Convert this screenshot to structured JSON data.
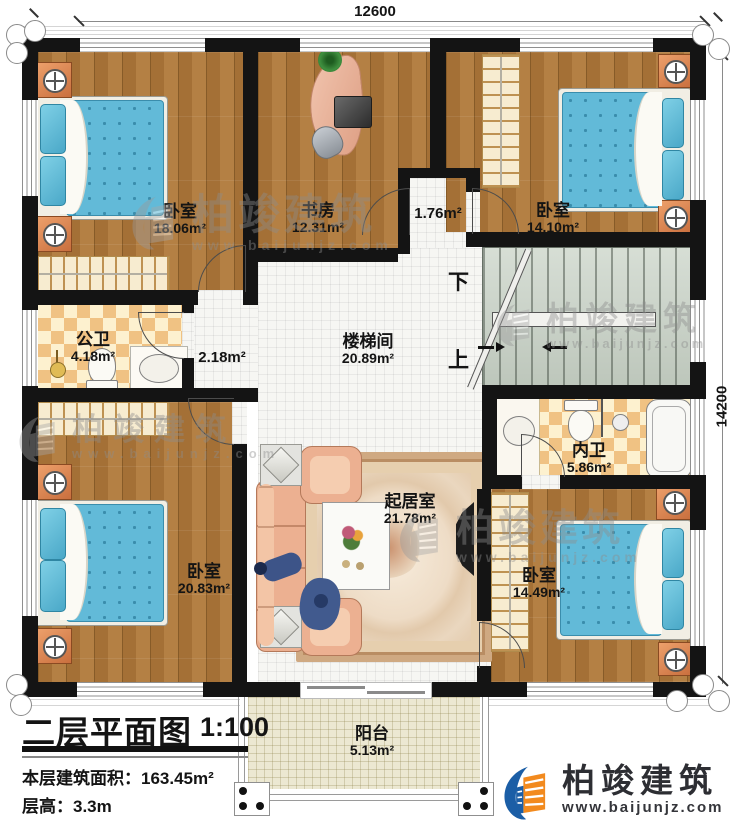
{
  "dimensions": {
    "top": "12600",
    "right": "14200"
  },
  "rooms": {
    "bedroom_tl": {
      "name": "卧室",
      "area": "18.06m²"
    },
    "study": {
      "name": "书房",
      "area": "12.31m²"
    },
    "hall_upper": {
      "area": "1.76m²"
    },
    "bedroom_tr": {
      "name": "卧室",
      "area": "14.10m²"
    },
    "public_bath": {
      "name": "公卫",
      "area": "4.18m²"
    },
    "hall_mid": {
      "area": "2.18m²"
    },
    "stairwell": {
      "name": "楼梯间",
      "area": "20.89m²"
    },
    "inner_bath": {
      "name": "内卫",
      "area": "5.86m²"
    },
    "living_room": {
      "name": "起居室",
      "area": "21.78m²"
    },
    "bedroom_bl": {
      "name": "卧室",
      "area": "20.83m²"
    },
    "bedroom_br": {
      "name": "卧室",
      "area": "14.49m²"
    },
    "balcony": {
      "name": "阳台",
      "area": "5.13m²"
    }
  },
  "stairs": {
    "down": "下",
    "up": "上"
  },
  "title_block": {
    "title": "二层平面图",
    "scale": "1:100",
    "area_label": "本层建筑面积：",
    "area_value": "163.45m²",
    "height_label": "层高：",
    "height_value": "3.3m"
  },
  "logo": {
    "brand": "柏竣建筑",
    "url": "www.baijunjz.com"
  },
  "watermark": {
    "brand": "柏竣建筑",
    "url": "www.baijunjz.com"
  },
  "colors": {
    "wall": "#141414",
    "wood": "#b0793a",
    "tile": "#f6f6f3",
    "checker_a": "#f0c283",
    "checker_b": "#fdf1cf",
    "stairs_bg": "#c9d3c7",
    "water": "#62bad8",
    "water_dark": "#3a8dac",
    "peach": "#ecb091",
    "cream": "#f7ecd0",
    "balcony": "#ece8d2",
    "logo_blue": "#1b5ea6",
    "logo_orange": "#f28a1e",
    "watermark_gray": "#8d8d8d"
  }
}
